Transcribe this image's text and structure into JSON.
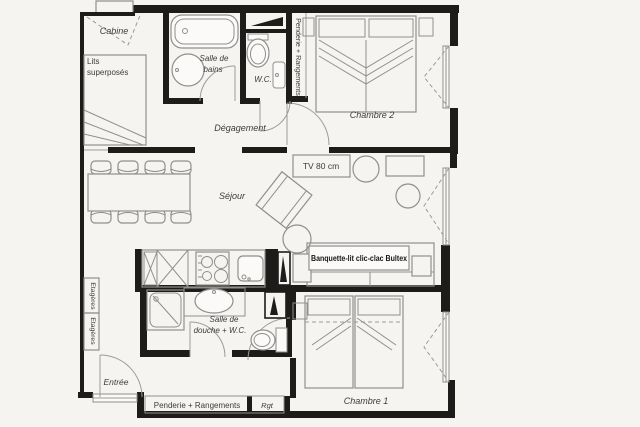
{
  "plan": {
    "title": "apartment-floor-plan",
    "labels": {
      "cabine": "Cabine",
      "lits_line1": "Lits",
      "lits_line2": "superposés",
      "bains_line1": "Salle de",
      "bains_line2": "bains",
      "wc": "W.C.",
      "penderie_top": "Penderie + Rangements",
      "chambre2": "Chambre 2",
      "degagement": "Dégagement",
      "sejour": "Séjour",
      "tv": "TV 80 cm",
      "banquette": "Banquette-lit clic-clac Bultex",
      "etageres": "Etagères",
      "entree": "Entrée",
      "douche_line1": "Salle de",
      "douche_line2": "douche + W.C.",
      "penderie_bottom": "Penderie + Rangements",
      "rgt": "Rgt",
      "chambre1": "Chambre 1"
    },
    "colors": {
      "paper": "#f5f4f1",
      "wall": "#1d1c1a",
      "furniture_line": "#8f8f8d",
      "text": "#3c3c3c"
    }
  }
}
